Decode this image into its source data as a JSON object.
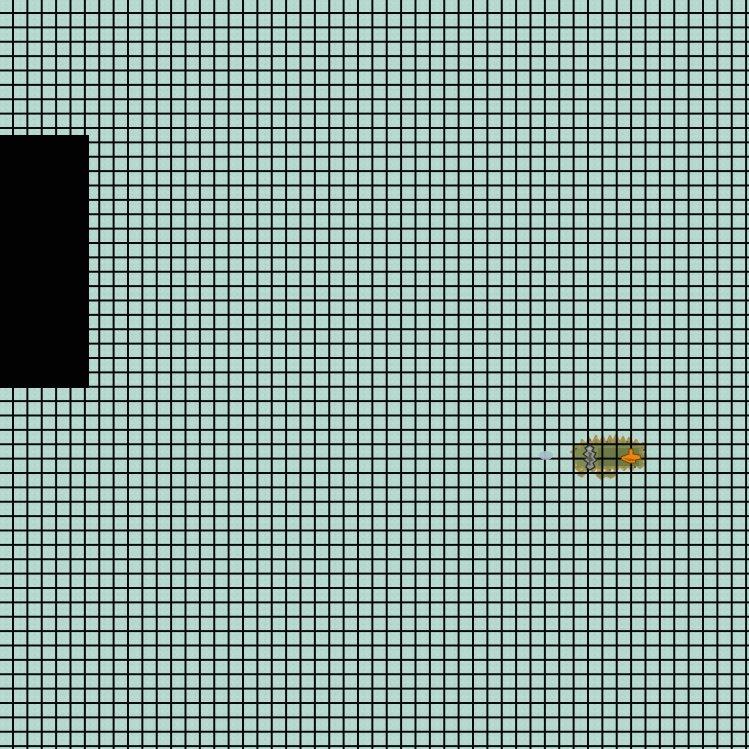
{
  "scene": {
    "type": "top-down-tile-grid-game-world",
    "width_px": 749,
    "height_px": 749,
    "background_color": "#b5d9ce",
    "texture_highlight": "rgba(255,255,255,0.12)",
    "texture_shade": "rgba(90,140,125,0.10)",
    "grid": {
      "line_color": "#070707",
      "line_width_px": 2,
      "cell_pitch_px": 14.38,
      "offset_x_px": 12,
      "offset_y_px": 12
    },
    "void_region": {
      "label": "unexplored-black-area",
      "x": 0,
      "y": 135,
      "width": 89,
      "height": 253,
      "color": "#020202"
    },
    "island": {
      "label": "grass-island-patch",
      "x": 566,
      "y": 432,
      "width": 84,
      "height": 50,
      "grass_color": "#7e8c51",
      "dark_patch_color": "#6d7a45",
      "shore_color": "#a98f4e",
      "shore_speckle_dark": "#59502b",
      "shore_speckle_light": "#c9ae6a"
    },
    "rock": {
      "label": "gray-rock-sprite",
      "x": 579,
      "y": 444,
      "width": 22,
      "height": 28,
      "fill": "#90948d",
      "outline": "#33362f",
      "shadow": "#5a5d57",
      "highlight": "#b3b6b0"
    },
    "orange_item": {
      "label": "orange-item-sprite",
      "x": 620,
      "y": 448,
      "width": 22,
      "height": 18,
      "fill": "#e8870f",
      "outline": "#7a4a08",
      "accent": "#b05f08"
    },
    "pebble": {
      "label": "small-blue-pebble-sprite",
      "x": 538,
      "y": 449,
      "width": 16,
      "height": 12,
      "fill": "#a9bfca",
      "shade": "#8ba2b0"
    }
  }
}
